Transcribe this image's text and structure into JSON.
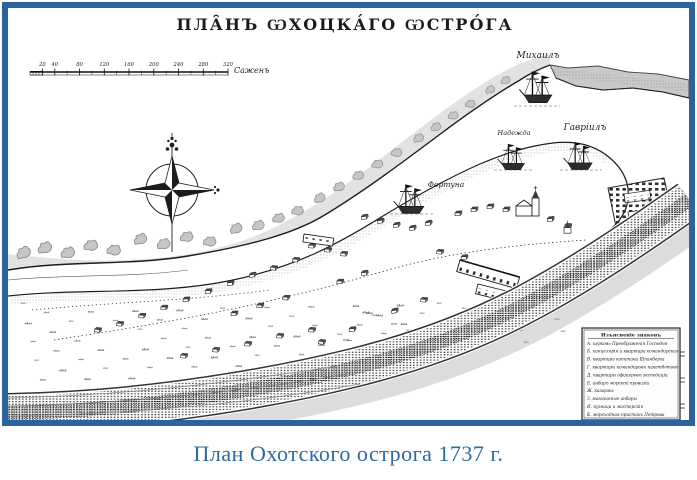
{
  "frame": {
    "border_color": "#2a639f"
  },
  "map": {
    "title": "ПЛА̑НЪ ѠХОЦКА́ГО ѠСТРО́ГА",
    "scale_bar": {
      "ticks": [
        "20",
        "40",
        "80",
        "120",
        "160",
        "200",
        "240",
        "280",
        "320"
      ],
      "unit": "Саженъ"
    },
    "compass": {
      "icon": "compass-rose"
    },
    "ships": [
      {
        "name": "Михаилъ"
      },
      {
        "name": "Надежда"
      },
      {
        "name": "Гавріилъ"
      },
      {
        "name": "Фортуна"
      }
    ],
    "legend": {
      "title": "Изъясненіе знаковъ",
      "items": [
        "А. церковь Преображенія Господня",
        "Б. канцелярія и квартира командирская",
        "В. квартира капитана Шпанберга",
        "Г. квартиры командировъ пакетботовъ",
        "Д. квартиры офицеровъ экспедиціи",
        "Е. анбаръ морской провизіи",
        "Ж. казармы",
        "З. магазинные анбары",
        "И. кузница и мастерскія",
        "К. мореходная пристань Петрова"
      ]
    },
    "ink_color": "#1c1c1c"
  },
  "caption": {
    "text": "План Охотского острога 1737 г.",
    "color": "#2d69a2"
  }
}
